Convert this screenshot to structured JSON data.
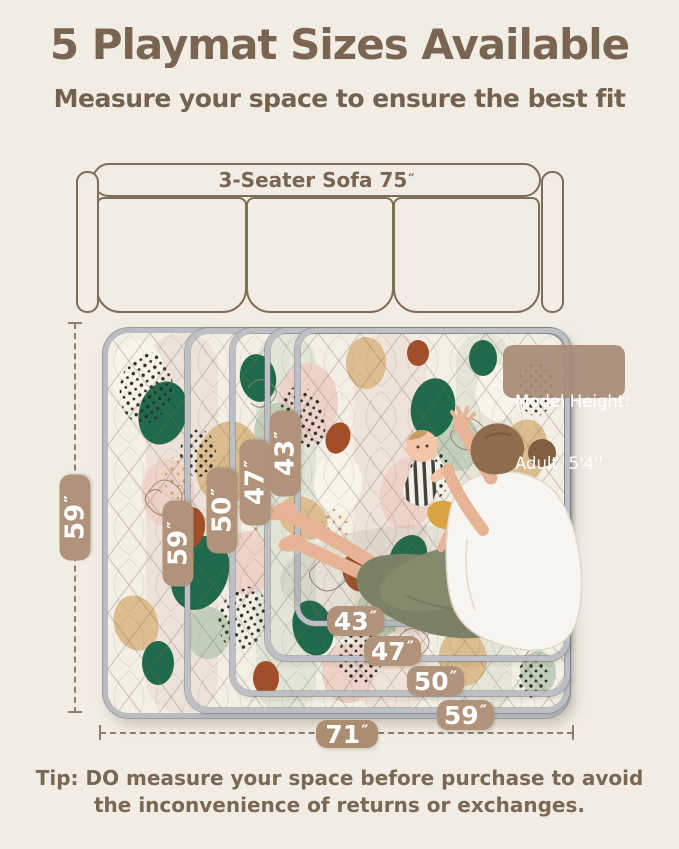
{
  "title": "5 Playmat Sizes Available",
  "subtitle": "Measure your space to ensure the best fit",
  "sofa": {
    "label": "3-Seater Sofa 75",
    "unit": "″"
  },
  "model_badge": {
    "line1": "Model Height:",
    "line2": "Adult  5'4''"
  },
  "dims": {
    "left_height": {
      "v": "59",
      "u": "″"
    },
    "bottom_width": {
      "v": "71",
      "u": "″"
    },
    "mat_heights": [
      {
        "v": "59",
        "u": "″"
      },
      {
        "v": "50",
        "u": "″"
      },
      {
        "v": "47",
        "u": "″"
      },
      {
        "v": "43",
        "u": "″"
      }
    ],
    "mat_widths": [
      {
        "v": "43",
        "u": "″"
      },
      {
        "v": "47",
        "u": "″"
      },
      {
        "v": "50",
        "u": "″"
      },
      {
        "v": "59",
        "u": "″"
      }
    ]
  },
  "tip": {
    "line1": "Tip: DO measure your space before purchase to avoid",
    "line2": "the inconvenience of returns or exchanges."
  },
  "colors": {
    "background": "#f1ede5",
    "accent_brown": "#7a6452",
    "badge_tan": "#b0937a",
    "mat_edge_gray": "#b9bdc2",
    "pattern_green": "#1e6a4b",
    "pattern_terracotta": "#a24e28",
    "pattern_tan": "#dcbd8f"
  }
}
